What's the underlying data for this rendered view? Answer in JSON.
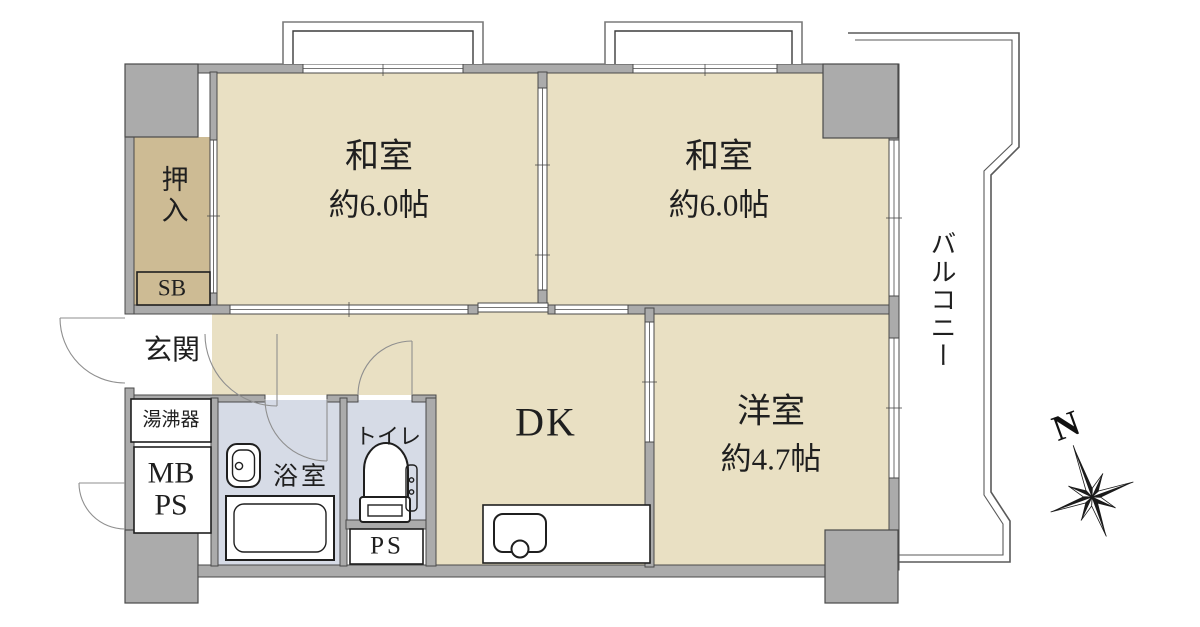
{
  "colors": {
    "bg": "#ffffff",
    "room": "#e9e0c3",
    "closet": "#cdbb94",
    "bath": "#d6dbe6",
    "wall": "#ababab",
    "wall_edge": "#4a4a4a",
    "line": "#1f1f1f",
    "arc": "#8f8f8f"
  },
  "rooms": {
    "washitsu_left": {
      "name": "和室",
      "size": "約6.0帖"
    },
    "washitsu_right": {
      "name": "和室",
      "size": "約6.0帖"
    },
    "yoshitsu": {
      "name": "洋室",
      "size": "約4.7帖"
    },
    "dk": {
      "label": "DK"
    },
    "genkan": {
      "label": "玄関"
    },
    "oshiire": {
      "label": "押入"
    },
    "sb": {
      "label": "SB"
    },
    "yuwakashiki": {
      "label": "湯沸器"
    },
    "mb": {
      "line1": "MB",
      "line2": "PS"
    },
    "bathroom": {
      "label": "浴室"
    },
    "toilet": {
      "label": "トイレ"
    },
    "ps": {
      "label": "PS"
    },
    "balcony": {
      "label": "バルコニー"
    }
  },
  "compass": {
    "north": "N"
  }
}
